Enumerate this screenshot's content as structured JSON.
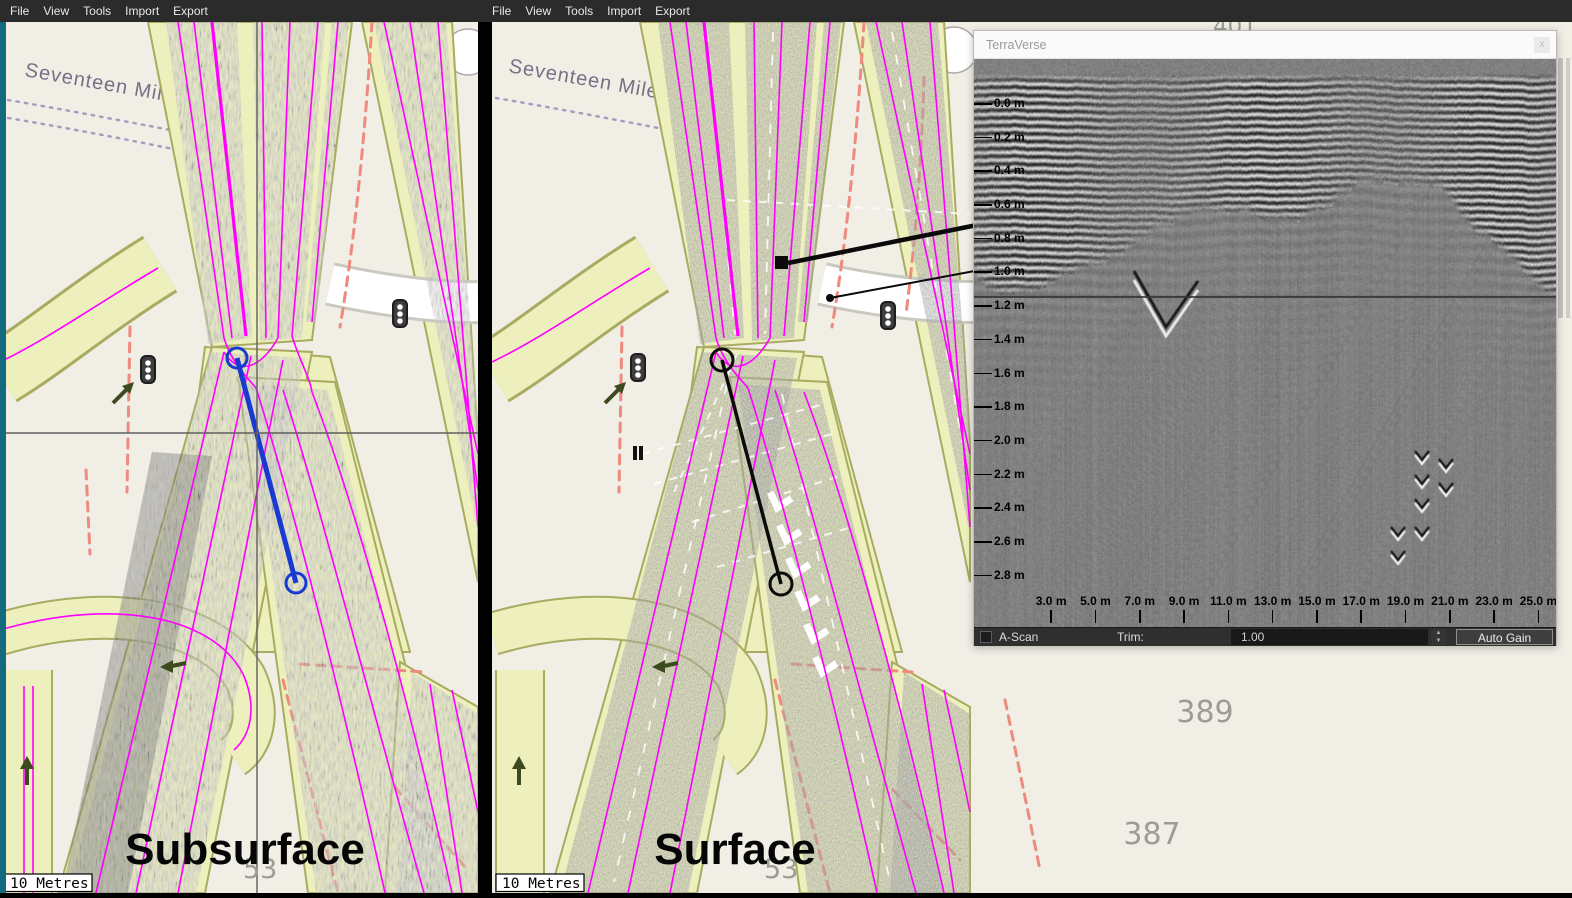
{
  "colors": {
    "magenta": "#ff00ff",
    "blue_measure": "#1839d2",
    "red_dash": "#ee8a7e",
    "road_fill": "#edefbd",
    "road_edge": "#a8ab60",
    "map_bg": "#f0eee5",
    "teal_edge": "#156b7e",
    "menu_bg": "#2b2b2b",
    "purple_dash": "#a79ac0"
  },
  "menu_bar": {
    "items": [
      "File",
      "View",
      "Tools",
      "Import",
      "Export"
    ]
  },
  "panels": {
    "left": {
      "mode_label": "Subsurface",
      "scale_label": "10 Metres",
      "street_label": "Seventeen Mile Rock",
      "parcel": "53"
    },
    "right": {
      "mode_label": "Surface",
      "scale_label": "10 Metres",
      "street_label": "Seventeen Mile Rock",
      "parcel": "53",
      "parcel_389": "389",
      "parcel_387": "387",
      "parcel_401": "401"
    }
  },
  "terraverse": {
    "title": "TerraVerse",
    "close_label": "x",
    "depth_axis": {
      "labels": [
        "0.0 m",
        "0.2 m",
        "0.4 m",
        "0.6 m",
        "0.8 m",
        "1.0 m",
        "1.2 m",
        "1.4 m",
        "1.6 m",
        "1.8 m",
        "2.0 m",
        "2.2 m",
        "2.4 m",
        "2.6 m",
        "2.8 m"
      ]
    },
    "distance_axis": {
      "labels": [
        "3.0 m",
        "5.0 m",
        "7.0 m",
        "9.0 m",
        "11.0 m",
        "13.0 m",
        "15.0 m",
        "17.0 m",
        "19.0 m",
        "21.0 m",
        "23.0 m",
        "25.0 m"
      ]
    },
    "controls": {
      "a_scan": "A-Scan",
      "trim": "Trim:",
      "trim_value": "1.00",
      "auto_gain": "Auto Gain"
    }
  }
}
